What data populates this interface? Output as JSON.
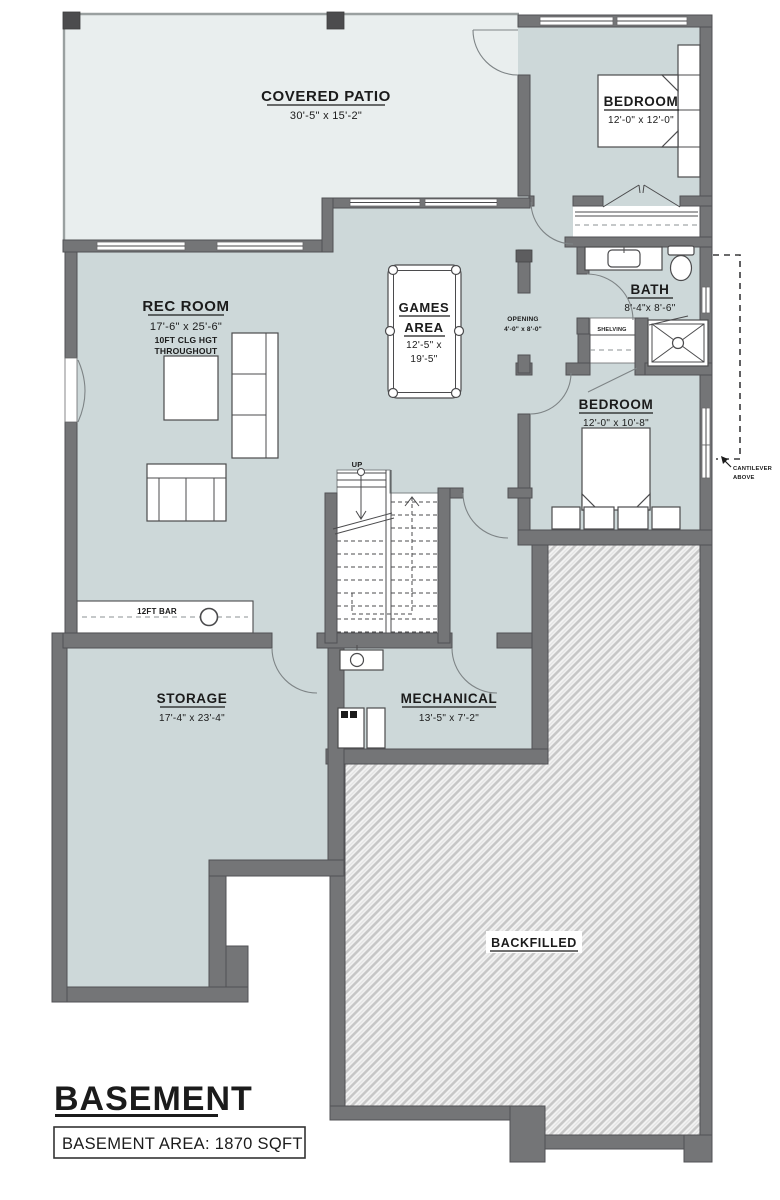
{
  "plan": {
    "title": "BASEMENT",
    "area_label": "BASEMENT AREA: 1870 SQFT",
    "rooms": {
      "covered_patio": {
        "name": "COVERED PATIO",
        "dims": "30'-5\" x 15'-2\""
      },
      "bedroom1": {
        "name": "BEDROOM",
        "dims": "12'-0\" x 12'-0\""
      },
      "rec_room": {
        "name": "REC ROOM",
        "dims": "17'-6\" x 25'-6\"",
        "note_line1": "10FT CLG HGT",
        "note_line2": "THROUGHOUT"
      },
      "games_area": {
        "name_line1": "GAMES",
        "name_line2": "AREA",
        "dims_line1": "12'-5\" x",
        "dims_line2": "19'-5\""
      },
      "bath": {
        "name": "BATH",
        "dims": "8'-4\"x 8'-6\""
      },
      "bedroom2": {
        "name": "BEDROOM",
        "dims": "12'-0\" x 10'-8\""
      },
      "storage": {
        "name": "STORAGE",
        "dims": "17'-4\" x 23'-4\""
      },
      "mechanical": {
        "name": "MECHANICAL",
        "dims": "13'-5\" x 7'-2\""
      },
      "backfilled": {
        "name": "BACKFILLED"
      }
    },
    "annotations": {
      "up": "UP",
      "bar": "12FT BAR",
      "shelving": "SHELVING",
      "opening_line1": "OPENING",
      "opening_line2": "4'-0\" x 8'-0\"",
      "cantilever_line1": "CANTILEVER",
      "cantilever_line2": "ABOVE"
    },
    "colors": {
      "wall": "#747577",
      "floor": "#cdd8d9",
      "patio_floor": "#e9eeee",
      "hatch_line": "#c6c6c6",
      "text": "#1b1b1b"
    }
  }
}
